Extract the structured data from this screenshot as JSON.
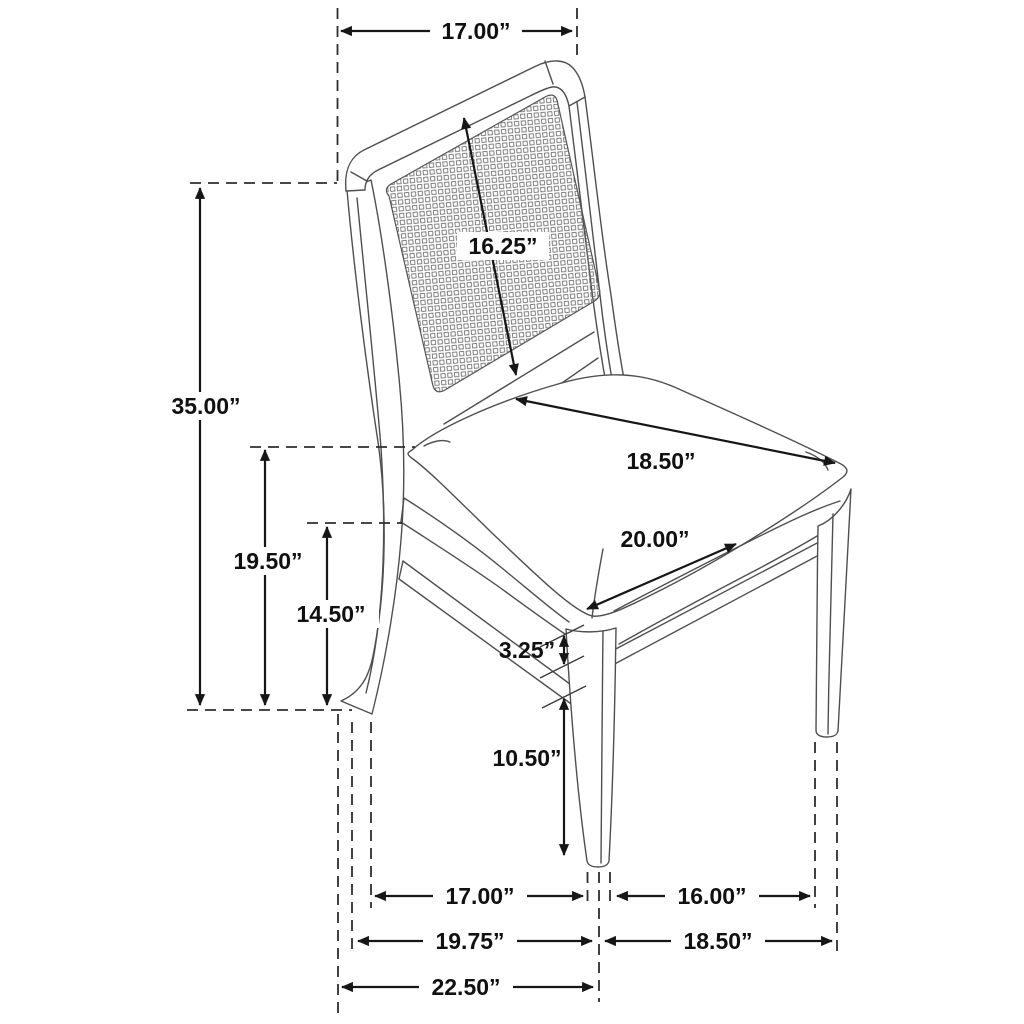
{
  "diagram": {
    "type": "furniture-dimension-drawing",
    "subject": "side chair with cane backrest and upholstered seat",
    "unit": "inches",
    "background_color": "#ffffff",
    "dimension_line_color": "#161616",
    "chair_line_color": "#4f4f4f",
    "dimensions": {
      "back_width": "17.00”",
      "backrest_height": "16.25”",
      "overall_height": "35.00”",
      "seat_back_height": "19.50”",
      "seat_front_height": "14.50”",
      "seat_depth": "18.50”",
      "seat_width": "20.00”",
      "rail_to_stretcher": "3.25”",
      "stretcher_to_floor": "10.50”",
      "side_legs_inner_span": "17.00”",
      "front_legs_inner_span": "16.00”",
      "side_legs_span": "19.75”",
      "front_legs_span": "18.50”",
      "overall_depth": "22.50”"
    }
  }
}
